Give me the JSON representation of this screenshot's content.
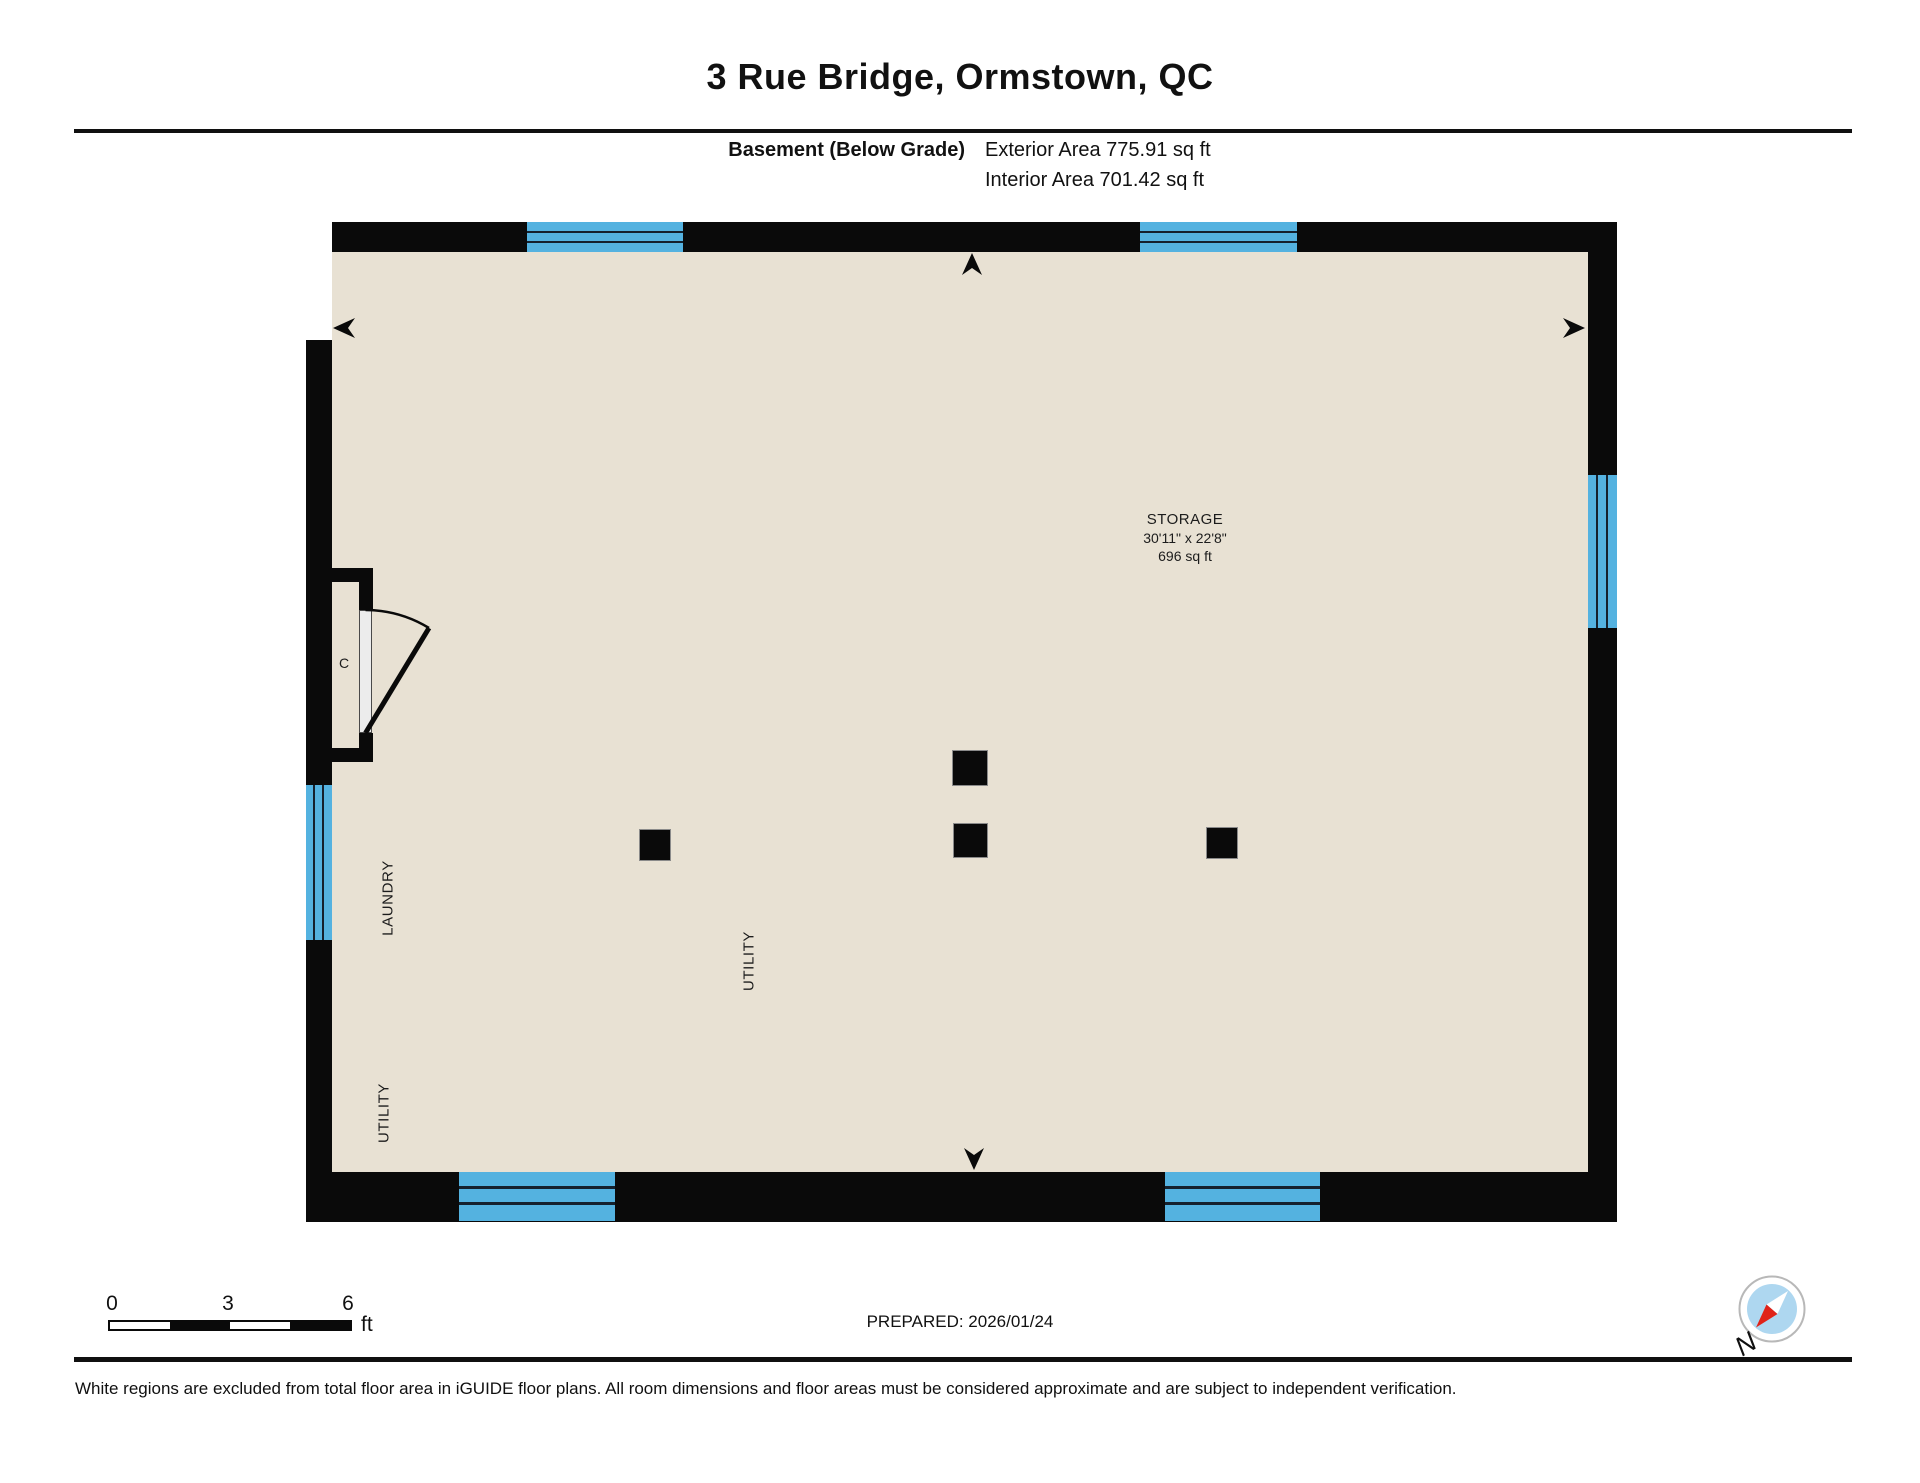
{
  "colors": {
    "wall": "#0a0a0a",
    "floor": "#e8e1d3",
    "window": "#54b2e0",
    "window-line": "#15212e",
    "compass-blue": "#aed7f0",
    "compass-red": "#e02319"
  },
  "header": {
    "title": "3 Rue Bridge, Ormstown, QC",
    "floor_label": "Basement (Below Grade)",
    "exterior_area": "Exterior Area 775.91 sq ft",
    "interior_area": "Interior Area 701.42 sq ft"
  },
  "plan": {
    "storage": {
      "name": "STORAGE",
      "dimensions": "30'11\" x 22'8\"",
      "area": "696 sq ft"
    },
    "labels": {
      "laundry": "LAUNDRY",
      "utility_left": "UTILITY",
      "utility_center": "UTILITY",
      "closet": "C"
    }
  },
  "footer": {
    "scale_ticks": [
      "0",
      "3",
      "6"
    ],
    "scale_unit": "ft",
    "prepared": "PREPARED: 2026/01/24",
    "compass_north": "N",
    "disclaimer": "White regions are excluded from total floor area in iGUIDE floor plans. All room dimensions and floor areas must be considered approximate and are subject to independent verification."
  }
}
